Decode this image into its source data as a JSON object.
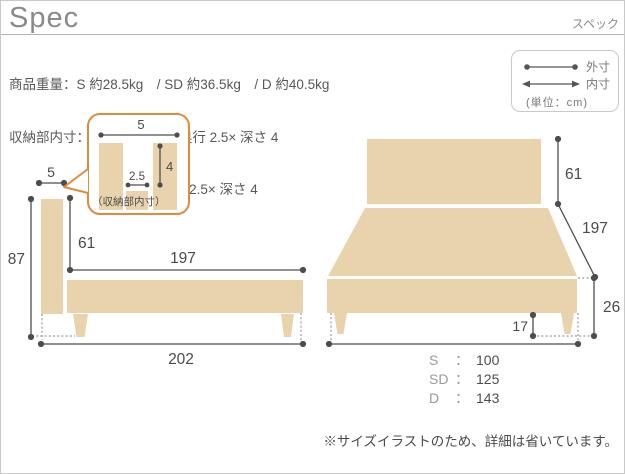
{
  "header": {
    "title": "Spec",
    "subtitle": "スペック",
    "lines": [
      "商品重量：S 約28.5kg　/ SD 約36.5kg　/ D 約40.5kg",
      "収納部内寸：S・SD 幅 75× 奥行 2.5× 深さ 4",
      "/ D 幅 118× 奥行 2.5× 深さ 4"
    ]
  },
  "legend": {
    "outer_label": "外寸",
    "inner_label": "内寸",
    "unit_label": "(単位：cm)",
    "icons": {
      "outer": "dot-ended-line-icon",
      "inner": "arrow-ended-line-icon"
    }
  },
  "colors": {
    "wood_tan": "#e9d3ac",
    "callout_orange": "#e08a3e",
    "measure_line": "#4d4d4d"
  },
  "side_view": {
    "dims": {
      "headboard_thickness": "5",
      "total_height": "87",
      "headboard_above_frame": "61",
      "inner_length": "197",
      "total_length": "202"
    },
    "callout": {
      "label": "（収納部内寸）",
      "top_width": "5",
      "slot_width": "2.5",
      "slot_depth": "4"
    }
  },
  "front_view": {
    "dims": {
      "headboard_height": "61",
      "length": "197",
      "frame_height": "26",
      "leg_height": "17"
    },
    "separator": "：",
    "widths": [
      {
        "size": "S",
        "value": "100"
      },
      {
        "size": "SD",
        "value": "125"
      },
      {
        "size": "D",
        "value": "143"
      }
    ]
  },
  "note": "※サイズイラストのため、詳細は省いています。"
}
